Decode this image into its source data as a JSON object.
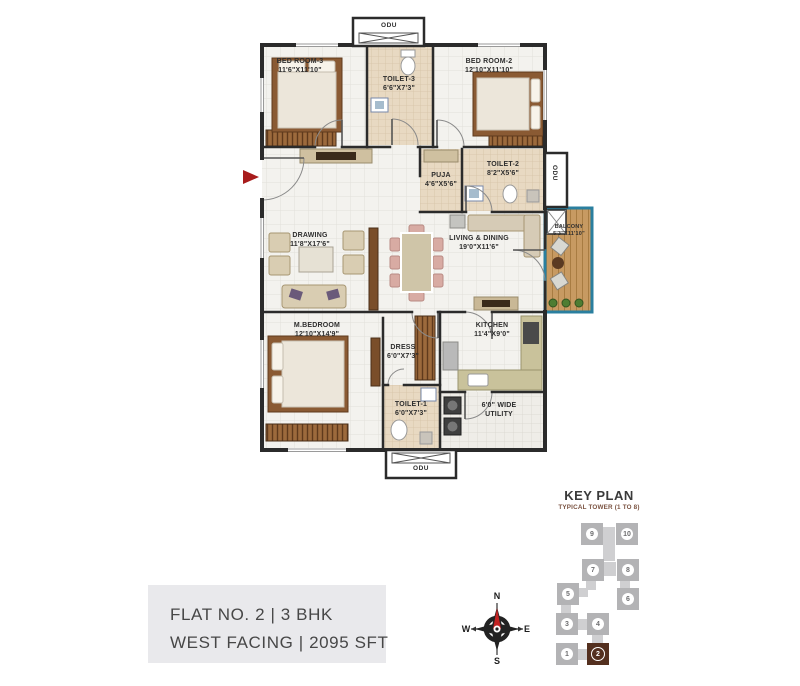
{
  "plan": {
    "rooms": [
      {
        "line1": "BED ROOM-3",
        "line2": "11'6\"X11'10\""
      },
      {
        "line1": "TOILET-3",
        "line2": "6'6\"X7'3\""
      },
      {
        "line1": "BED ROOM-2",
        "line2": "12'10\"X11'10\""
      },
      {
        "line1": "PUJA",
        "line2": "4'6\"X5'6\""
      },
      {
        "line1": "TOILET-2",
        "line2": "8'2\"X5'6\""
      },
      {
        "line1": "BALCONY",
        "line2": "5'3\"X11'10\""
      },
      {
        "line1": "DRAWING",
        "line2": "11'8\"X17'6\""
      },
      {
        "line1": "LIVING & DINING",
        "line2": "19'0\"X11'6\""
      },
      {
        "line1": "M.BEDROOM",
        "line2": "12'10\"X14'9\""
      },
      {
        "line1": "DRESS",
        "line2": "6'0\"X7'3\""
      },
      {
        "line1": "KITCHEN",
        "line2": "11'4\"X9'0\""
      },
      {
        "line1": "TOILET-1",
        "line2": "6'0\"X7'3\""
      },
      {
        "line1": "6'0\" WIDE",
        "line2": "UTILITY"
      }
    ],
    "odu": {
      "top": "ODU",
      "right": "ODU",
      "bottom": "ODU"
    }
  },
  "key_plan": {
    "title": "KEY PLAN",
    "subtitle": "TYPICAL TOWER (1 TO 8)",
    "units": [
      {
        "number": "9",
        "highlighted": false
      },
      {
        "number": "10",
        "highlighted": false
      },
      {
        "number": "7",
        "highlighted": false
      },
      {
        "number": "8",
        "highlighted": false
      },
      {
        "number": "5",
        "highlighted": false
      },
      {
        "number": "6",
        "highlighted": false
      },
      {
        "number": "3",
        "highlighted": false
      },
      {
        "number": "4",
        "highlighted": false
      },
      {
        "number": "1",
        "highlighted": false
      },
      {
        "number": "2",
        "highlighted": true
      }
    ]
  },
  "info_panel": {
    "line1": "FLAT NO. 2  |  3 BHK",
    "line2": "WEST FACING  |  2095 SFT"
  },
  "compass": {
    "north": "N",
    "south": "S",
    "east": "E",
    "west": "W"
  },
  "colors": {
    "wall": "#2b2b2b",
    "balcony_border": "#2a7f9f",
    "balcony_wood": "#c79a62",
    "highlight_unit": "#54301f",
    "keyplan_gray": "#b3b3b5",
    "entrance_arrow": "#a81c1c",
    "info_bar": "#4a2d1d",
    "info_bg": "#e9e9ec"
  }
}
